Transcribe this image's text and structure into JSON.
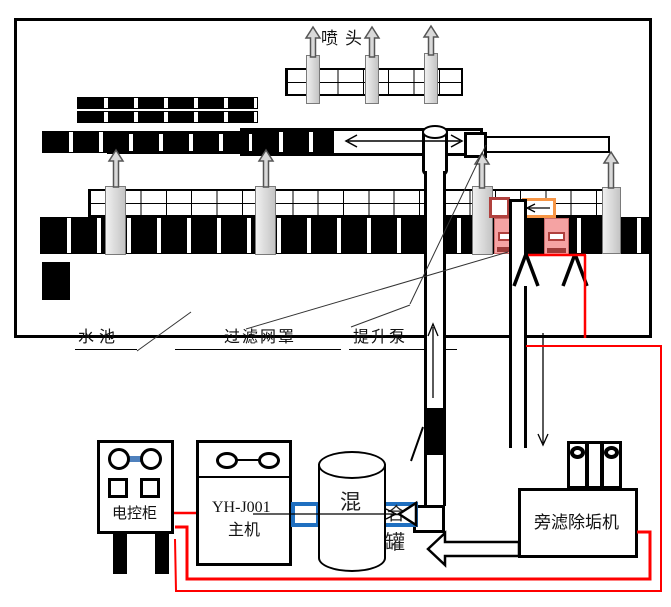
{
  "diagram": {
    "title_note": "cooling water spray pool and descaling system schematic",
    "labels": {
      "spray_head": "喷头",
      "pool": "水池",
      "filter_mesh": "过滤网罩",
      "lift_pump": "提升泵",
      "control_cabinet": "电控柜",
      "host_model": "YH-J001",
      "host_name": "主机",
      "mixing_tank_chars": [
        "混",
        "合",
        "罐"
      ],
      "side_filter": "旁滤除垢机"
    },
    "icons": {
      "up_flow_arrow": "gray-up-arrow",
      "down_flow_arrow": "thin-down-arrow",
      "both_ways_arrow": "double-headed-arrow",
      "suction_strainer": "hollow-triangle",
      "return_arrow": "large-hollow-left-arrow",
      "valve": "black-valve-on-pipe"
    },
    "colors": {
      "wire_red": "#ff0000",
      "connector_blue": "#1f6fc0",
      "cabinet_link_blue": "#4f81bd",
      "highlight_maroon": "#b0413e",
      "highlight_orange": "#f79646",
      "pump_pink": "#f5a3a3",
      "equipment_gray": "#d9d9d9",
      "line_black": "#000000"
    }
  }
}
